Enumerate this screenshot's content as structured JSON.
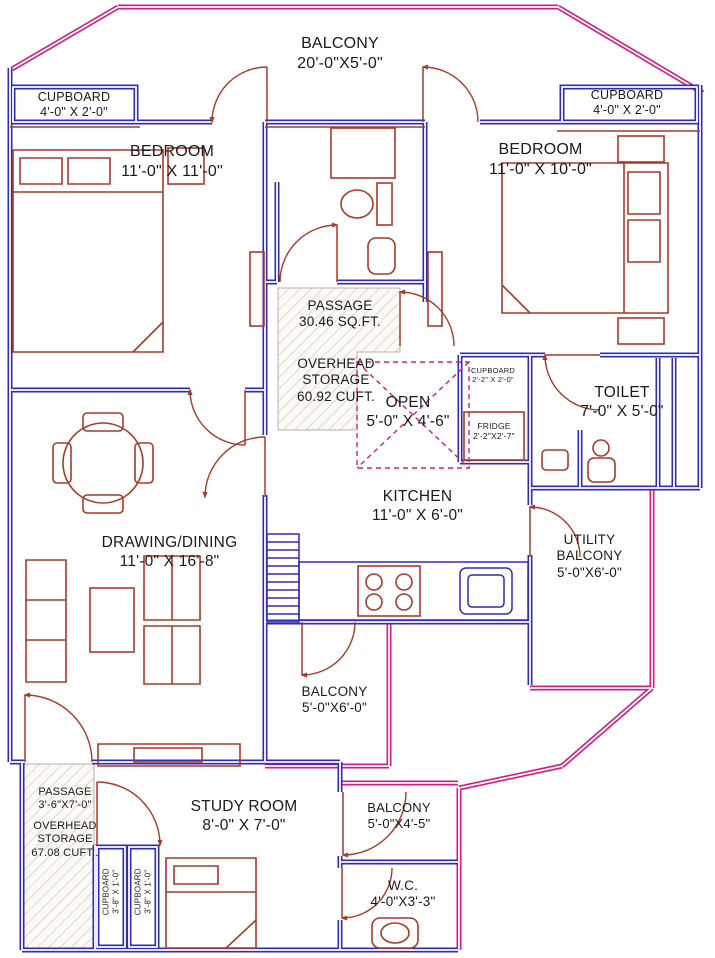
{
  "drawing_type": "residential floor plan",
  "colors": {
    "wall_blue": "#2d2db4",
    "balcony_pink": "#d81b7f",
    "furniture_red": "#a93a28",
    "hatch_gray": "#cfc8c0",
    "text": "#1a1a1a"
  },
  "rooms": [
    {
      "id": "balcony-top",
      "name": "BALCONY",
      "dims": "20'-0\"X5'-0\""
    },
    {
      "id": "cupboard-top-left",
      "name": "CUPBOARD",
      "dims": "4'-0\" X 2'-0\""
    },
    {
      "id": "cupboard-top-right",
      "name": "CUPBOARD",
      "dims": "4'-0\" X 2'-0\""
    },
    {
      "id": "bedroom-left",
      "name": "BEDROOM",
      "dims": "11'-0\" X 11'-0\""
    },
    {
      "id": "bedroom-right",
      "name": "BEDROOM",
      "dims": "11'-0\" X 10'-0\""
    },
    {
      "id": "passage-upper",
      "name": "PASSAGE",
      "dims": "30.46 SQ.FT."
    },
    {
      "id": "overhead-storage-upper",
      "name": "OVERHEAD STORAGE",
      "dims": "60.92 CUFT."
    },
    {
      "id": "open-area",
      "name": "OPEN",
      "dims": "5'-0\" X 4'-6\""
    },
    {
      "id": "cupboard-kitchen",
      "name": "CUPBOARD",
      "dims": "2'-2\" X 2'-0\""
    },
    {
      "id": "fridge",
      "name": "FRIDGE",
      "dims": "2'-2\"X2'-7\""
    },
    {
      "id": "toilet",
      "name": "TOILET",
      "dims": "7'-0\" X 5'-0\""
    },
    {
      "id": "kitchen",
      "name": "KITCHEN",
      "dims": "11'-0\" X 6'-0\""
    },
    {
      "id": "utility-balcony",
      "name": "UTILITY BALCONY",
      "dims": "5'-0\"X6'-0\""
    },
    {
      "id": "drawing-dining",
      "name": "DRAWING/DINING",
      "dims": "11'-0\" X 16'-8\""
    },
    {
      "id": "balcony-mid",
      "name": "BALCONY",
      "dims": "5'-0\"X6'-0\""
    },
    {
      "id": "passage-lower",
      "name": "PASSAGE",
      "dims": "3'-6\"X7'-0\""
    },
    {
      "id": "overhead-storage-lower",
      "name": "OVERHEAD STORAGE",
      "dims": "67.08 CUFT.."
    },
    {
      "id": "study-room",
      "name": "STUDY ROOM",
      "dims": "8'-0\" X 7'-0\""
    },
    {
      "id": "balcony-bottom",
      "name": "BALCONY",
      "dims": "5'-0\"X4'-5\""
    },
    {
      "id": "wc",
      "name": "W.C.",
      "dims": "4'-0\"X3'-3\""
    },
    {
      "id": "cupboard-study-1",
      "name": "CUPBOARD",
      "dims": "3'-8\" X 1'-0\""
    },
    {
      "id": "cupboard-study-2",
      "name": "CUPBOARD",
      "dims": "3'-8\" X 1'-0\""
    }
  ]
}
